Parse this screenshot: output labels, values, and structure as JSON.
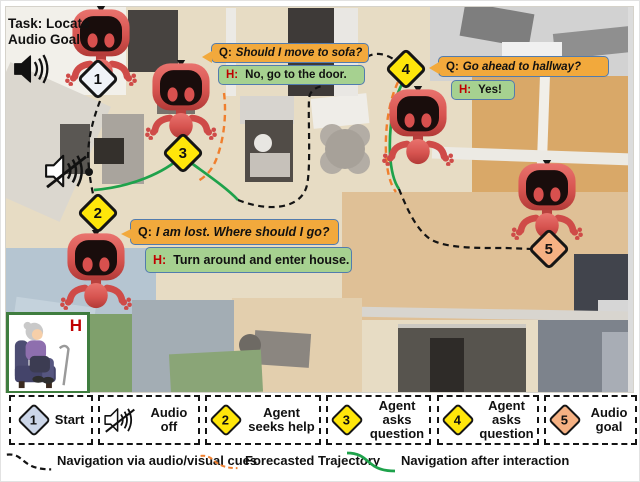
{
  "task": {
    "line1": "Task: Locate",
    "line2": "Audio Goal"
  },
  "human_label": "H",
  "markers": {
    "start": {
      "label": "1"
    },
    "seek_help": {
      "label": "2"
    },
    "ask1": {
      "label": "3"
    },
    "ask2": {
      "label": "4"
    },
    "audio_goal": {
      "label": "5"
    }
  },
  "dialogues": {
    "sofa": {
      "q_prefix": "Q:",
      "q": "Should I move to sofa?",
      "h_prefix": "H:",
      "h": "No, go to the door."
    },
    "hallway": {
      "q_prefix": "Q:",
      "q": "Go ahead to hallway?",
      "h_prefix": "H:",
      "h": "Yes!"
    },
    "lost": {
      "q_prefix": "Q:",
      "q": "I am lost. Where should I go?",
      "h_prefix": "H:",
      "h": "Turn around and enter house."
    }
  },
  "legend": {
    "items": [
      {
        "number": "1",
        "text": "Start"
      },
      {
        "number": "",
        "text": "Audio off"
      },
      {
        "number": "2",
        "text": "Agent seeks help"
      },
      {
        "number": "3",
        "text": "Agent asks question"
      },
      {
        "number": "4",
        "text": "Agent asks question"
      },
      {
        "number": "5",
        "text": "Audio goal"
      }
    ]
  },
  "trajectory_legend": [
    {
      "text": "Navigation via audio/visual cues",
      "style": "black-dashed"
    },
    {
      "text": "Forecasted Trajectory",
      "style": "orange-dashed"
    },
    {
      "text": "Navigation after interaction",
      "style": "green-solid"
    }
  ],
  "colors": {
    "bubble_question": "#f2a93c",
    "bubble_human": "#a6d190",
    "bubble_border": "#527cae",
    "human_letter": "#c00000",
    "trajectory_audio": "#141414",
    "trajectory_forecast": "#f07f2d",
    "trajectory_interaction": "#1ea24b",
    "diamond_yellow": "#ffe60a",
    "diamond_goal": "#f5b183",
    "diamond_start_map": "#f0f3f8",
    "diamond_start_legend": "#ccd6e8"
  }
}
